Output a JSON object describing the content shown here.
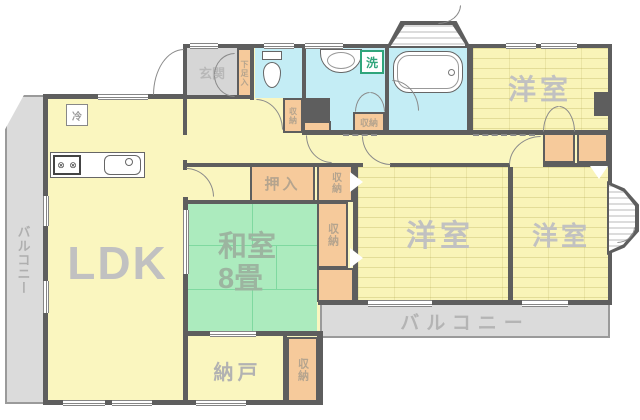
{
  "rooms": {
    "ldk": "LDK",
    "washitsu_line1": "和室",
    "washitsu_line2": "8畳",
    "youshitsu_top": "洋室",
    "youshitsu_middle": "洋室",
    "youshitsu_right": "洋室",
    "nando": "納戸",
    "genkan": "玄関",
    "balcony_left": "バルコニー",
    "balcony_bottom": "バルコニー"
  },
  "storage": {
    "oshiire": "押入",
    "shoe_cabinet": "下足入",
    "closet_hall": "収納",
    "closet_washroom": "収納",
    "closet_beside_oshiire": "収納",
    "closet_middle": "収納",
    "closet_nando": "収納"
  },
  "fixtures": {
    "washing_machine": "洗",
    "refrigerator": "冷"
  },
  "colors": {
    "wall": "#5E5E5E",
    "room_yellow": "#FAF6BF",
    "tatami_green": "#ACEBBE",
    "water_cyan": "#C4EDF5",
    "closet_orange": "#F6CA9B",
    "balcony_gray": "#DBDBDB",
    "entrance_gray": "#D6D6D6",
    "label_gray": "#C1C1C1",
    "washer_green": "#2FA57B"
  }
}
